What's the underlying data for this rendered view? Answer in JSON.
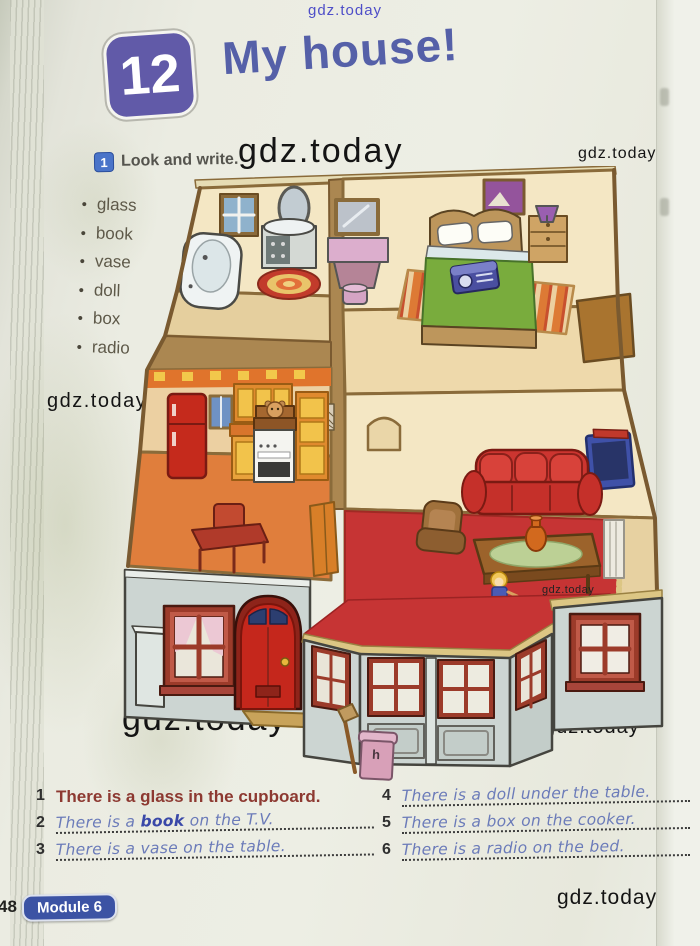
{
  "watermarks": {
    "top": "gdz.today",
    "header_center": "gdz.today",
    "header_right": "gdz.today",
    "mid_left": "gdz.today",
    "mid_center": "gdz.today",
    "scene_small": "gdz.today",
    "bottom_left": "gdz.today",
    "bottom_right": "gdz.today",
    "footer_right": "gdz.today"
  },
  "header": {
    "module_number": "12",
    "title": "My house!"
  },
  "task": {
    "number": "1",
    "instruction": "Look and write."
  },
  "word_list": {
    "items": [
      "glass",
      "book",
      "vase",
      "doll",
      "box",
      "radio"
    ]
  },
  "sentences": {
    "left": [
      {
        "num": "1",
        "text": "There is a glass in the cupboard.",
        "style": "printed"
      },
      {
        "num": "2",
        "pre": "There is a ",
        "word": "book",
        "post": " on the T.V.",
        "style": "handwritten"
      },
      {
        "num": "3",
        "text": "There is a vase on the table.",
        "style": "handwritten"
      }
    ],
    "right": [
      {
        "num": "4",
        "text": "There is a doll under the table.",
        "style": "handwritten"
      },
      {
        "num": "5",
        "text": "There is a box on the cooker.",
        "style": "handwritten"
      },
      {
        "num": "6",
        "text": "There is a radio on the bed.",
        "style": "handwritten"
      }
    ]
  },
  "footer": {
    "page_number": "48",
    "module_label": "Module 6"
  },
  "scene": {
    "bin_label": "h",
    "rooms": [
      "bathroom",
      "bedroom",
      "kitchen",
      "living-room",
      "house-front"
    ],
    "objects": [
      "bathtub",
      "washbasin",
      "oval-mirror",
      "round-rug",
      "bathroom-window",
      "wall-mirror",
      "dressing-table",
      "stool",
      "picture",
      "bed",
      "pillows",
      "green-blanket",
      "radio-on-bed",
      "bedside-table",
      "lamp",
      "striped-rug",
      "desk",
      "fridge",
      "kitchen-window",
      "cupboards",
      "cooker",
      "box-with-hamster-on-cooker",
      "kitchen-table",
      "sofa",
      "armchair",
      "coffee-table",
      "vase-on-table",
      "doll-under-table",
      "tv-with-book",
      "red-rug",
      "radiator",
      "front-door",
      "doormat",
      "left-window",
      "bay-window",
      "right-window",
      "pink-bin",
      "broom"
    ]
  },
  "palette": {
    "title": "#5560a8",
    "module_badge_12": "#615aa8",
    "task_badge": "#4a74c9",
    "printed_sentence": "#8d3931",
    "handwriting": "#6b7bb9",
    "handwriting_dark": "#3948a8",
    "module6_badge": "#3c53a4",
    "paper": "#ebece2",
    "wall_cream": "#f4e7c4",
    "kitchen_floor": "#e07e3c",
    "rug_red": "#c63434",
    "exterior_gray": "#ccd5d2",
    "door_red": "#c5271c",
    "frame_red": "#9c3b2a",
    "eave_tan": "#dcc684",
    "fridge_red": "#c52a1c",
    "blanket_green": "#79ac3d"
  }
}
